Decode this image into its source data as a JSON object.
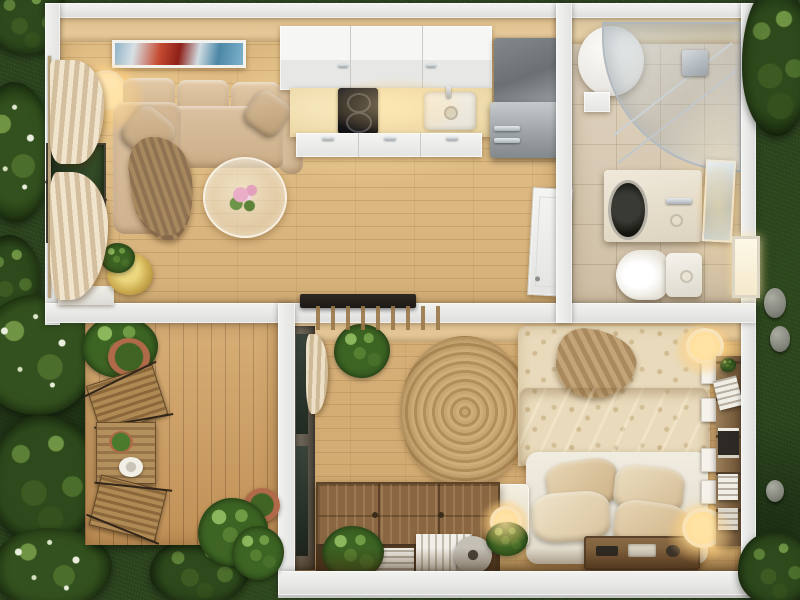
{
  "scene": {
    "description": "Photorealistic top-down 3D floor plan render of a small one-bedroom house at dusk, surrounded by a dark green lawn with shrubs",
    "view": "top-down",
    "rooms_count": 4
  },
  "palette": {
    "grass": "#2c451e",
    "wall": "#eaebe9",
    "wood": "#e4c28a",
    "wood_deep": "#cc9d62",
    "tile": "#d8c8ae",
    "glow": "#ffdf9e",
    "sofa": "#d8bd9c",
    "bed": "#e8dabb",
    "rug": "#c2a06b",
    "chest": "#8a6742",
    "cabinet": "#f0f1ef",
    "steel": "#9aa0a4",
    "foliage": "#3c6423",
    "terracotta": "#b06a49"
  },
  "rooms": {
    "living_room": {
      "label": "Living room",
      "items": [
        "beige sectional sofa with chaise",
        "two throw pillows",
        "fringed brown throw blanket",
        "round glass coffee table with pink flowers",
        "abstract wall art",
        "glowing floor lamp",
        "sheer curtains on picture window",
        "plant in gold pot on white bench"
      ]
    },
    "kitchen": {
      "label": "Kitchen",
      "items": [
        "white upper cabinets",
        "white base cabinets",
        "lit countertop",
        "two-burner black cooktop",
        "white single sink with faucet",
        "stainless refrigerator with tall cabinet",
        "open white entry door",
        "dark doormat"
      ]
    },
    "bathroom": {
      "label": "Bathroom",
      "items": [
        "round white water heater",
        "curved glass corner shower with chrome rails",
        "vanity with built-in washing machine",
        "wall mirror",
        "toilet",
        "small lit window"
      ]
    },
    "bedroom": {
      "label": "Bedroom",
      "items": [
        "double bed with patterned cream duvet",
        "tan throw",
        "four pillows on white bed frame",
        "wooden storage tray at headboard",
        "round woven jute rug",
        "white nightstand cube with lamp",
        "two glowing wall sconces",
        "wooden bookshelf with books",
        "four picture frames",
        "wooden chest coffee table with books and disc",
        "potted plants",
        "glass door with curtain",
        "slatted canopy"
      ]
    },
    "deck": {
      "label": "Deck",
      "items": [
        "square wooden bistro table",
        "potted plant and white plate on table",
        "two folding wooden chairs",
        "terracotta planters",
        "corner shrubs"
      ]
    }
  },
  "exterior": {
    "label": "Lawn",
    "items": [
      "dark green grass",
      "flowering shrubs",
      "hedges",
      "gray stones"
    ]
  }
}
